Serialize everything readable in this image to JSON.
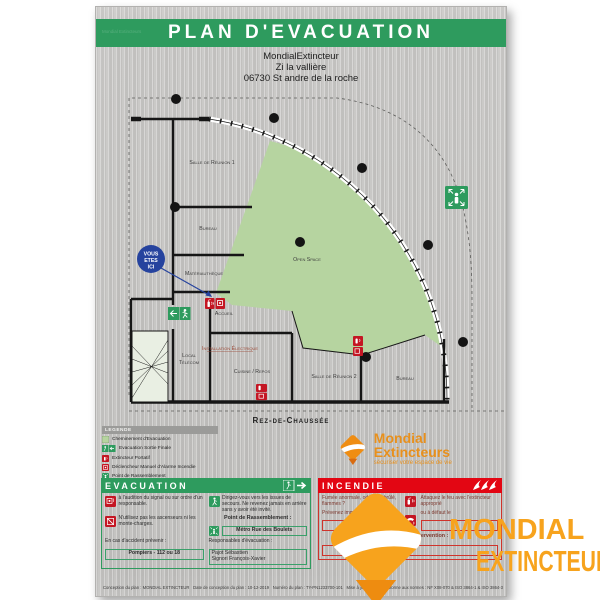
{
  "poster": {
    "title": "PLAN D'EVACUATION",
    "address_line1": "MondialExtincteur",
    "address_line2": "Zi la vallière",
    "address_line3": "06730 St andre de la roche"
  },
  "plan": {
    "floor_label": "Rez-de-Chaussée",
    "you_are_here_l1": "VOUS",
    "you_are_here_l2": "ETES",
    "you_are_here_l3": "ICI",
    "rooms": {
      "salle_reunion_1": "Salle de Réunion 1",
      "bureau_1": "Bureau",
      "materiautheque": "Matériauthèque",
      "accueil": "Accueil",
      "local_telecom_l1": "Local",
      "local_telecom_l2": "Télécom",
      "installation_electrique": "Installation Électrique",
      "cuisine_repos": "Cuisine / Repos",
      "open_space": "Open Space",
      "salle_reunion_2": "Salle de Réunion 2",
      "bureau_2": "Bureau"
    }
  },
  "legend": {
    "header": "LEGENDE",
    "items": [
      {
        "icon": "evacuation-path-swatch",
        "label": "Cheminement d'Evacuation"
      },
      {
        "icon": "exit-sign-icon",
        "label": "Evacuation Sortie Finale"
      },
      {
        "icon": "extinguisher-icon",
        "label": "Extincteur Portatif"
      },
      {
        "icon": "manual-alarm-icon",
        "label": "Déclencheur Manuel d'Alarme Incendie"
      },
      {
        "icon": "assembly-point-icon",
        "label": "Point de Rassemblement"
      }
    ]
  },
  "brand": {
    "name": "Mondial Extincteurs",
    "tagline": "sécuriser votre espace de vie"
  },
  "evacuation": {
    "header": "EVACUATION",
    "signal": "à l'audition du signal ou sur ordre d'un responsable.",
    "issues": "Dirigez-vous vers les issues de secours. Ne revenez jamais en arrière sans y avoir été invité.",
    "ascenseurs": "N'utilisez pas les ascenseurs ni les monte-charges.",
    "rassemblement_label": "Point de Rassemblement :",
    "rassemblement_value": "Métro Rue des Boulets",
    "accident_label": "En cas d'accident prévenir :",
    "accident_value": "Pompiers - 112 ou 18",
    "responsables_label": "Responsables d'évacuation :",
    "responsable_1": "Pajot Sébastien",
    "responsable_2": "Signori François-Xavier"
  },
  "incendie": {
    "header": "INCENDIE",
    "fumee": "Fumée anormale, odeur de brûlé, flammes ?",
    "prevenez_label": "Prévenez immédiatement :",
    "telephone_value": "18 ou 112",
    "attaquez": "Attaquez le feu avec l'extincteur approprié",
    "defaut_label": "ou à défaut le",
    "responsables_label": "Responsables d'intervention :"
  },
  "footer": {
    "conception": "Conception du plan : MONDIAL EXTINCTEUR",
    "date": "Date de conception du plan : 10-12-2019",
    "numero": "Numéro du plan : TY-PN1233700-101",
    "mise_a_jour": "Mise à jour N° : 1",
    "normes": "Conforme aux normes : NF X08-070 & ISO 3864-1 & ISO 3864-3"
  },
  "watermark": {
    "line1": "MONDIAL",
    "line2": "EXTINCTEUR"
  },
  "colors": {
    "banner_green": "#2e9b5e",
    "incendie_red": "#e30613",
    "evacuation_area_green": "#b6d4a0",
    "brand_orange": "#f7a31d",
    "you_are_here_blue": "#26439e"
  }
}
